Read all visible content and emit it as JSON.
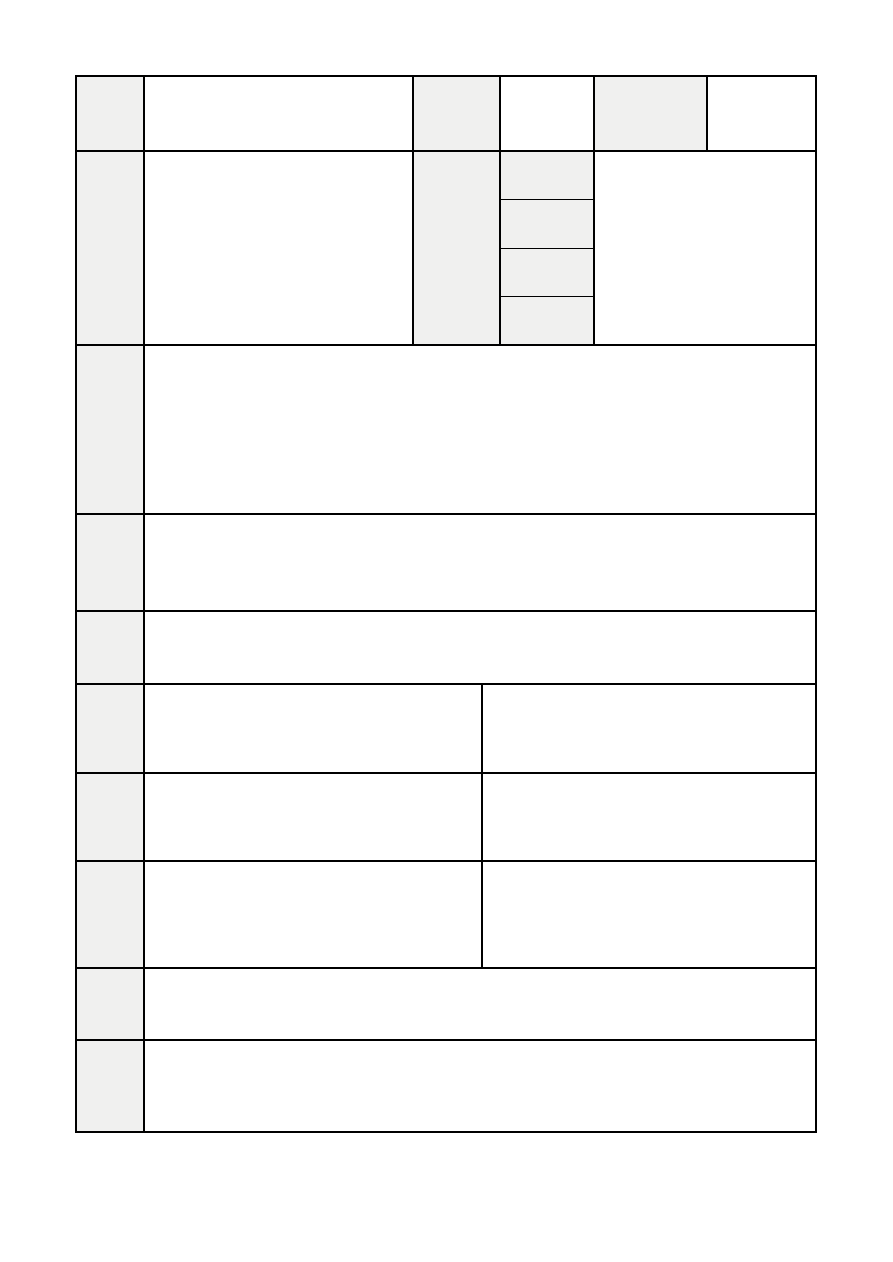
{
  "page": {
    "background": "#ffffff",
    "width": 893,
    "height": 1262
  },
  "table": {
    "border_color": "#000000",
    "shaded_cell_color": "#f0f0ef",
    "x": 75,
    "y": 75,
    "width": 742,
    "height": 1058,
    "rows": [
      {
        "name": "row-1",
        "height": 75,
        "cells": [
          {
            "w": 68,
            "shaded": true,
            "text": ""
          },
          {
            "w": 269,
            "shaded": false,
            "text": ""
          },
          {
            "w": 87,
            "shaded": true,
            "text": ""
          },
          {
            "w": 94,
            "shaded": false,
            "text": ""
          },
          {
            "w": 113,
            "shaded": true,
            "text": ""
          },
          {
            "w": 111,
            "shaded": false,
            "text": ""
          }
        ]
      },
      {
        "name": "row-2",
        "height": 194,
        "cells": [
          {
            "w": 68,
            "shaded": true,
            "text": ""
          },
          {
            "w": 269,
            "shaded": false,
            "text": ""
          },
          {
            "w": 87,
            "shaded": true,
            "text": ""
          },
          {
            "w": 94,
            "shaded": false,
            "text": "",
            "subrows": [
              {
                "shaded": true,
                "text": ""
              },
              {
                "shaded": true,
                "text": ""
              },
              {
                "shaded": true,
                "text": ""
              },
              {
                "shaded": true,
                "text": ""
              }
            ]
          },
          {
            "w": 224,
            "shaded": false,
            "text": ""
          }
        ]
      },
      {
        "name": "row-3",
        "height": 169,
        "cells": [
          {
            "w": 68,
            "shaded": true,
            "text": ""
          },
          {
            "w": 674,
            "shaded": false,
            "text": ""
          }
        ]
      },
      {
        "name": "row-4",
        "height": 97,
        "cells": [
          {
            "w": 68,
            "shaded": true,
            "text": ""
          },
          {
            "w": 674,
            "shaded": false,
            "text": ""
          }
        ]
      },
      {
        "name": "row-5",
        "height": 73,
        "cells": [
          {
            "w": 68,
            "shaded": true,
            "text": ""
          },
          {
            "w": 674,
            "shaded": false,
            "text": ""
          }
        ]
      },
      {
        "name": "row-6",
        "height": 89,
        "cells": [
          {
            "w": 68,
            "shaded": true,
            "text": ""
          },
          {
            "w": 338,
            "shaded": false,
            "text": ""
          },
          {
            "w": 336,
            "shaded": false,
            "text": ""
          }
        ]
      },
      {
        "name": "row-7",
        "height": 88,
        "cells": [
          {
            "w": 68,
            "shaded": true,
            "text": ""
          },
          {
            "w": 338,
            "shaded": false,
            "text": ""
          },
          {
            "w": 336,
            "shaded": false,
            "text": ""
          }
        ]
      },
      {
        "name": "row-8",
        "height": 107,
        "cells": [
          {
            "w": 68,
            "shaded": true,
            "text": ""
          },
          {
            "w": 338,
            "shaded": false,
            "text": ""
          },
          {
            "w": 336,
            "shaded": false,
            "text": ""
          }
        ]
      },
      {
        "name": "row-9",
        "height": 72,
        "cells": [
          {
            "w": 68,
            "shaded": true,
            "text": ""
          },
          {
            "w": 674,
            "shaded": false,
            "text": ""
          }
        ]
      },
      {
        "name": "row-10",
        "height": 94,
        "cells": [
          {
            "w": 68,
            "shaded": true,
            "text": ""
          },
          {
            "w": 674,
            "shaded": false,
            "text": ""
          }
        ]
      }
    ]
  }
}
